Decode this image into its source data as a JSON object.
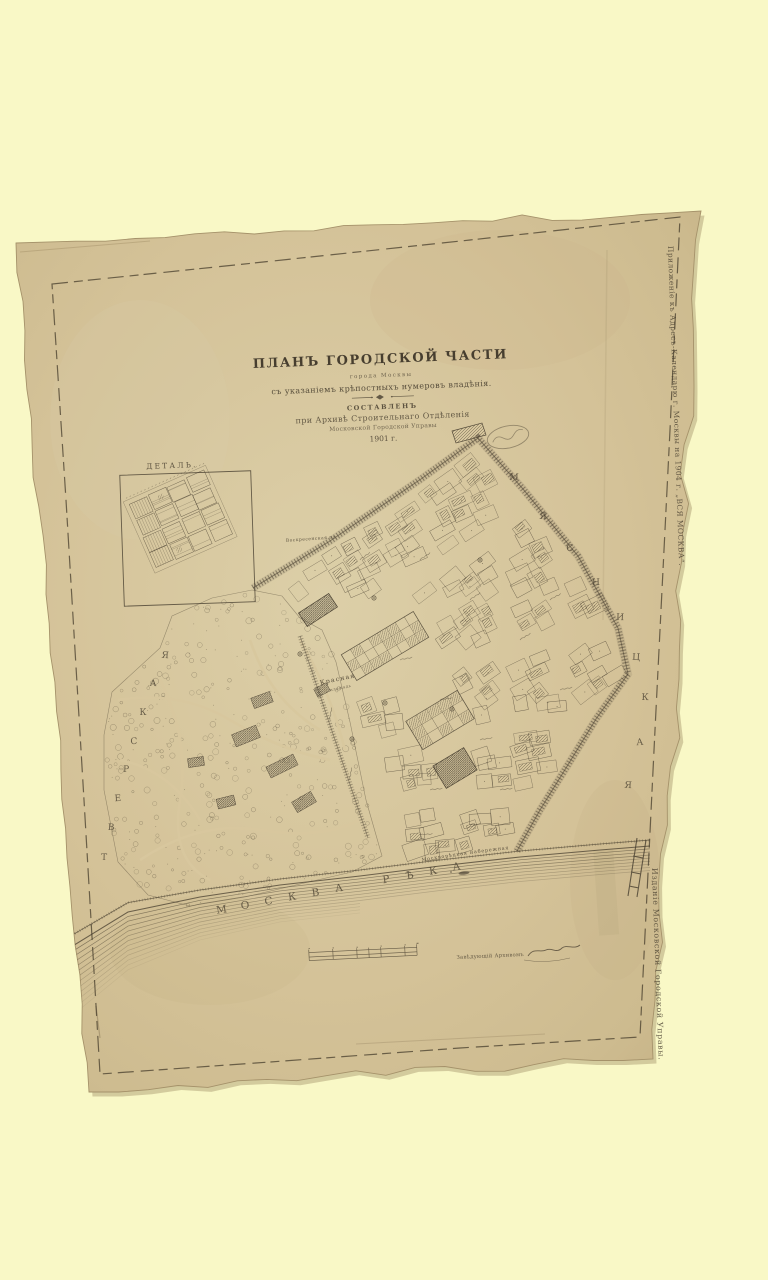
{
  "scan": {
    "background_color": "#f9f8c6",
    "paper_color": "#d5c399",
    "ink_color": "#473e2f"
  },
  "margins": {
    "top_right_vertical": "Приложеніе къ Адресъ-Календарю г. Москвы на 1904 г. „ВСЯ МОСКВА“.",
    "bottom_right_vertical": "Изданіе Московской Городской Управы."
  },
  "title_block": {
    "title": "ПЛАНЪ ГОРОДСКОЙ ЧАСТИ",
    "subtitle_city": "города Москвы",
    "subtitle_note": "съ указаніемъ крѣпостныхъ нумеровъ владѣнія.",
    "compiled_heading": "СОСТАВЛЕНЪ",
    "compiled_line1": "при Архивѣ Строительнаго Отдѣленія",
    "compiled_line2": "Московской Городской Управы",
    "year": "1901 г."
  },
  "inset": {
    "label": "ДЕТАЛЬ."
  },
  "map_labels": {
    "district_left": "ТВЕРСКАЯ",
    "district_right": "МЯСНИЦКАЯ",
    "river": "МОСКВА РѢКА",
    "embankment": "Москворѣцкая набережная",
    "square_line1": "Красная",
    "square_line2": "площадь",
    "square_north": "Воскресенская пл."
  },
  "footer": {
    "archivist": "Завѣдующій Архивомъ"
  }
}
